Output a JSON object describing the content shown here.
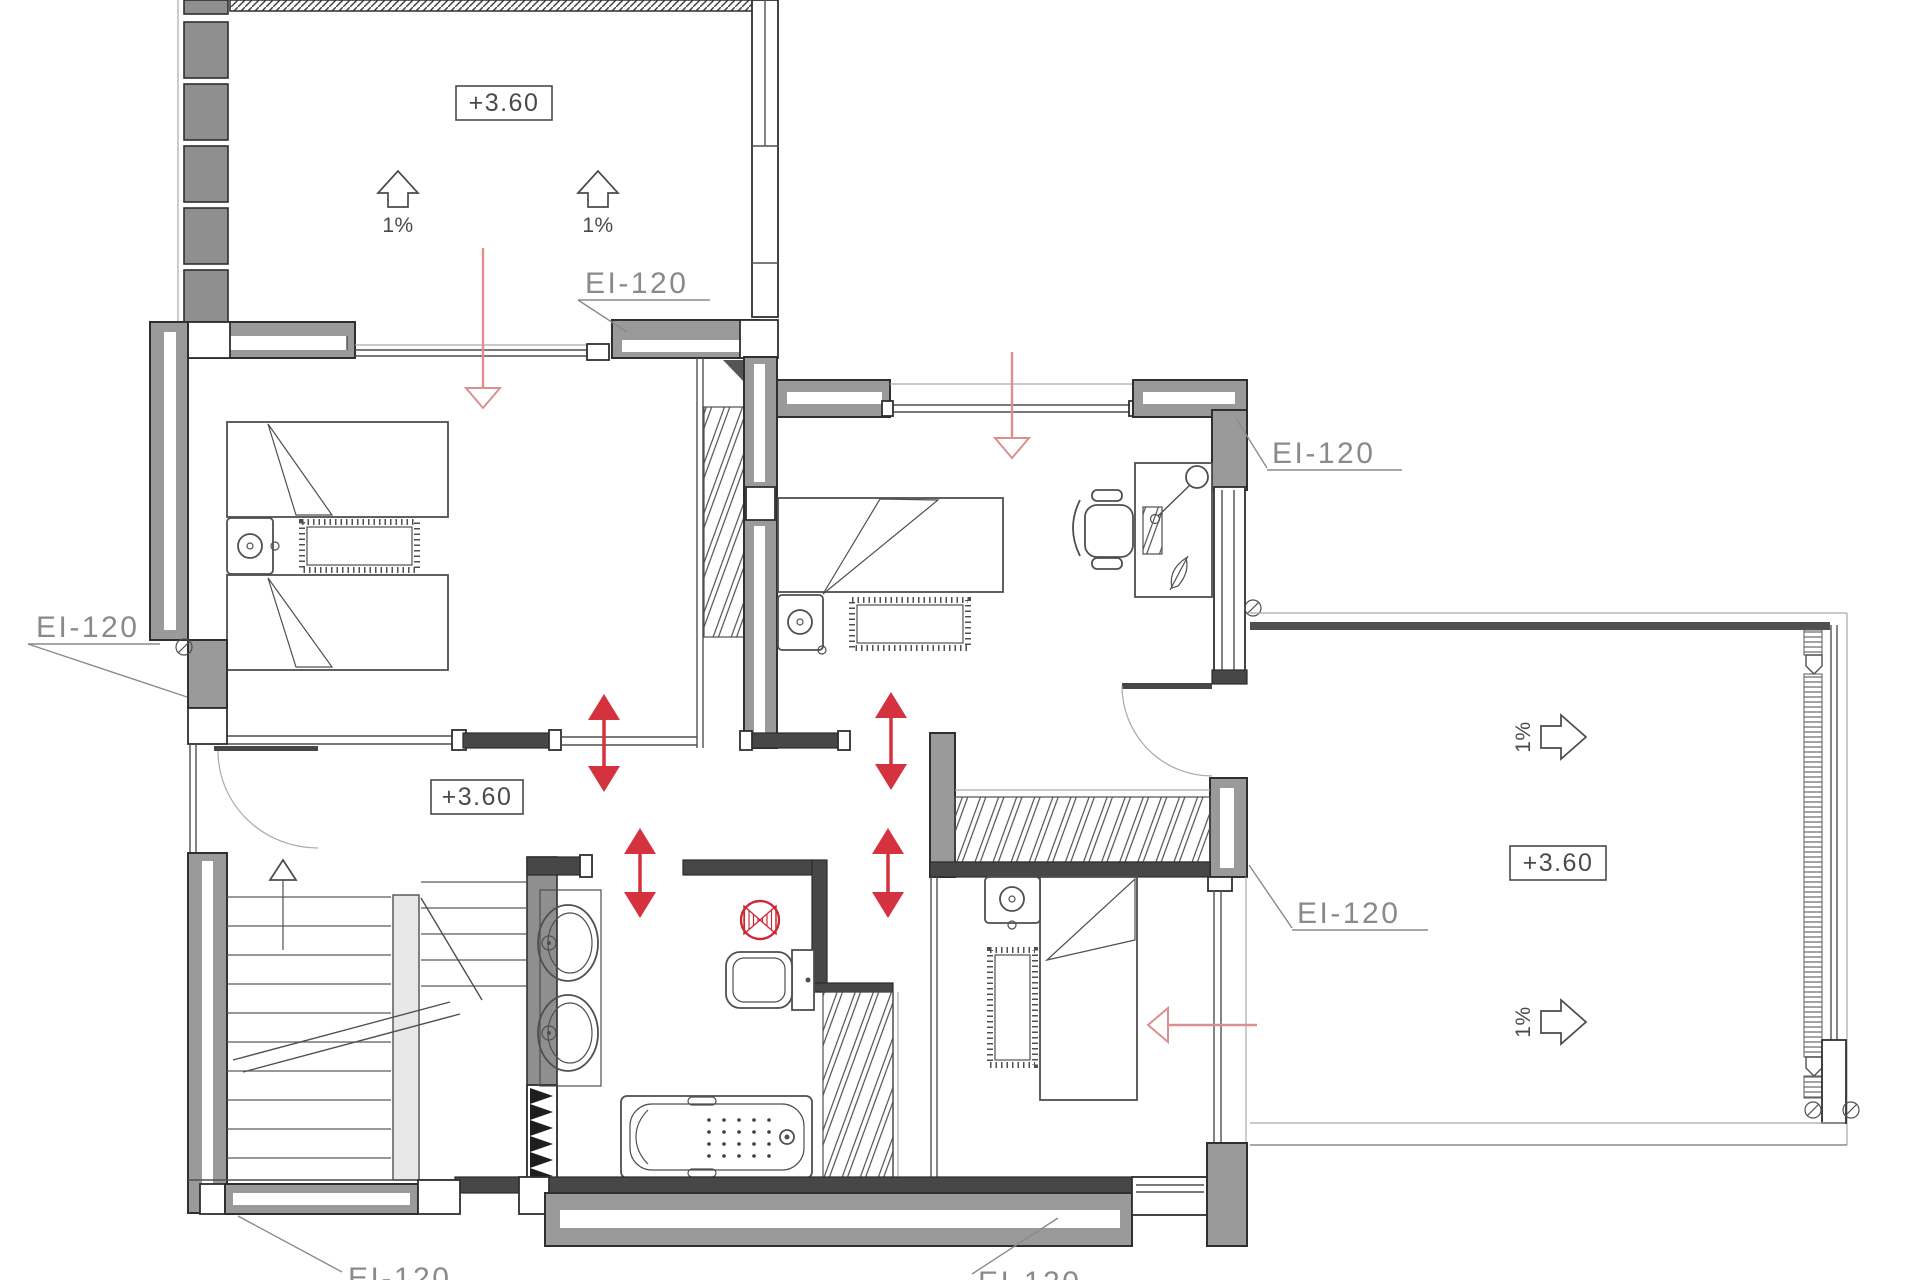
{
  "plan": {
    "type": "architectural-floor-plan-upper-storey",
    "floor_elevation": "+3.60",
    "elevation_labels": [
      "+3.60",
      "+3.60",
      "+3.60"
    ],
    "fire_rating_labels": [
      "EI-120",
      "EI-120",
      "EI-120",
      "EI-120",
      "EI-120",
      "EI-120"
    ],
    "slope_labels": [
      "1%",
      "1%",
      "1%",
      "1%"
    ],
    "colors": {
      "wall_fill": "#9a9a9a",
      "wall_outline": "#2f2f2f",
      "dark_wall": "#474747",
      "furniture_line": "#4f4f4f",
      "airflow_arrow_red": "#d4323f",
      "direction_arrow_pink": "#dc8f8f",
      "extractor_fan_red": "#cc2936",
      "label_gray": "#8a8a8a",
      "text_dark": "#4a4a4a"
    },
    "icons": [
      "bed-icon",
      "pillow-fold-icon",
      "nightstand-lamp-icon",
      "rug-icon",
      "desk-icon",
      "office-chair-icon",
      "desk-lamp-icon",
      "keyboard-icon",
      "pen-icon",
      "sink-icon",
      "toilet-icon",
      "bathtub-icon",
      "extractor-fan-icon",
      "wardrobe-hatch-icon",
      "stair-up-arrow-icon",
      "door-swing-icon",
      "slope-arrow-icon",
      "flow-arrow-icon",
      "screw-icon",
      "shaft-hatch-icon"
    ]
  }
}
